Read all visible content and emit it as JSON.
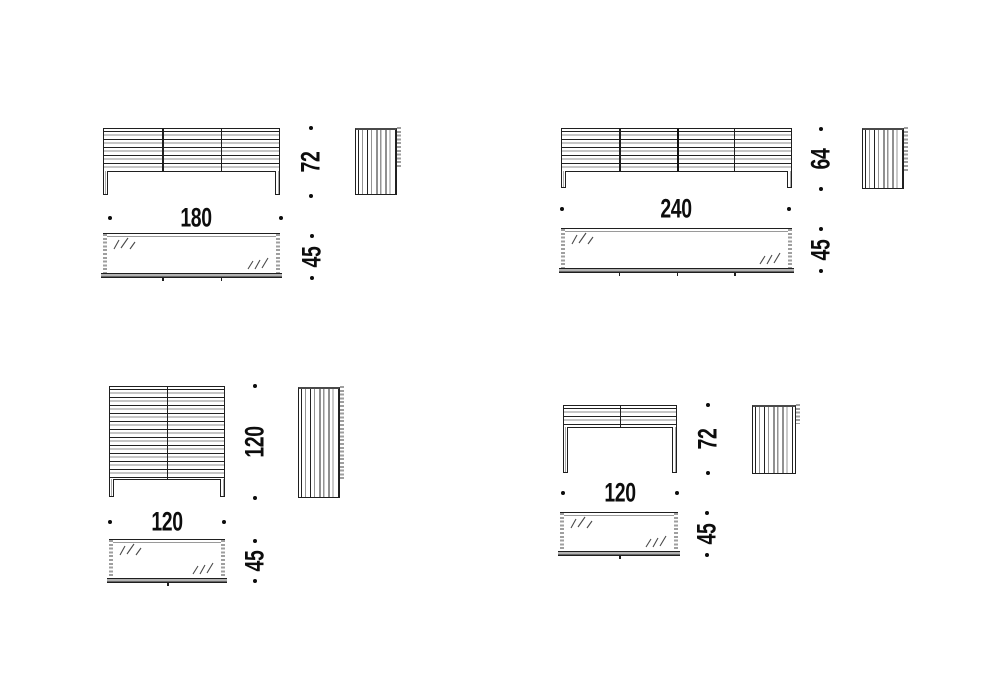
{
  "drawing": {
    "background": "#ffffff",
    "line_color": "#1f1f1f",
    "shade_color": "#9a9a9a",
    "groups": [
      {
        "width_label": "180",
        "height_label": "72",
        "depth_label": "45",
        "door_count": 3
      },
      {
        "width_label": "240",
        "height_label": "64",
        "depth_label": "45",
        "door_count": 4
      },
      {
        "width_label": "120",
        "height_label": "120",
        "depth_label": "45",
        "door_count": 2
      },
      {
        "width_label": "120",
        "height_label": "72",
        "depth_label": "45",
        "door_count": 2
      }
    ]
  }
}
